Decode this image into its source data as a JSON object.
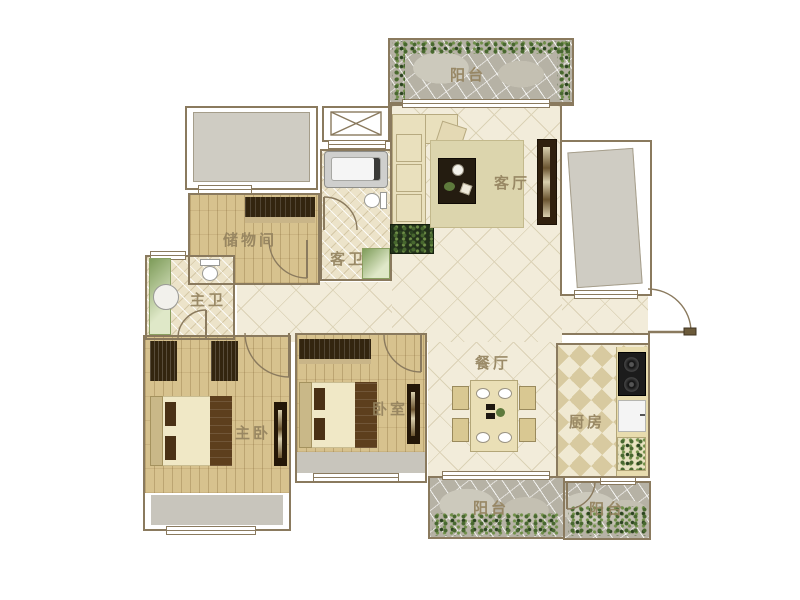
{
  "plan": {
    "labels": {
      "balcony_top": "阳台",
      "living_room": "客厅",
      "storage_room": "储物间",
      "guest_bathroom": "客卫",
      "master_bathroom": "主卫",
      "master_bedroom": "主卧",
      "bedroom": "卧室",
      "dining_room": "餐厅",
      "kitchen": "厨房",
      "balcony_bottom_left": "阳台",
      "balcony_bottom_right": "阳台"
    },
    "colors": {
      "wall": "#8a7a5e",
      "label_text": "#94835f",
      "tile_floor": "#f2ecda",
      "wood_floor": "#d7c28e",
      "bath_tile": "#ece3c9",
      "kitchen_checker_dark": "#d8caa0",
      "balcony_stone": "#b6b2a5",
      "plant_green": "#48682f",
      "furniture_dark": "#33250f",
      "fabric_cream": "#e9e0bd",
      "gray_area": "#cfccc3"
    }
  }
}
